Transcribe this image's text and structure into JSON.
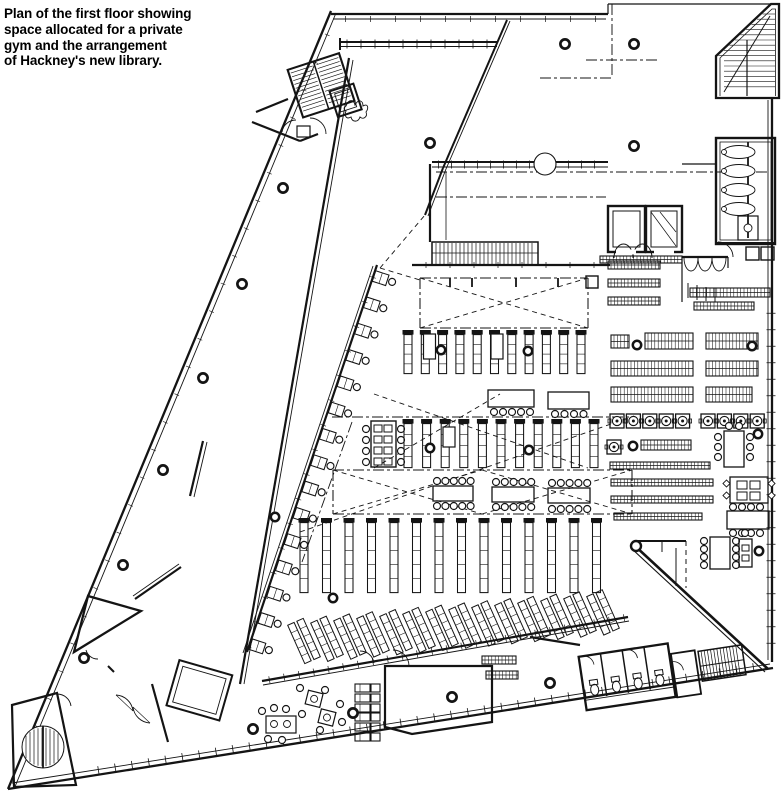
{
  "caption": {
    "lines": [
      "Plan of the first floor showing",
      "space allocated for a private",
      "gym and the arrangement",
      "of Hackney's new library."
    ]
  },
  "plan": {
    "type": "architectural floor plan",
    "floor": "first floor",
    "building": "Hackney's new library",
    "drawing_color": "#141414",
    "paper_color": "#ffffff",
    "spaces": [
      "private gym wing",
      "entrance hall",
      "escalator",
      "lifts",
      "toilets north-east",
      "toilets south-east",
      "library bookstacks",
      "slanted display shelving",
      "reading tables",
      "study carrels",
      "study desks along gym wall",
      "cafe seating",
      "stair north-west",
      "stair north-east",
      "stair south-east",
      "spiral stair south-west",
      "ramp south-east"
    ]
  }
}
